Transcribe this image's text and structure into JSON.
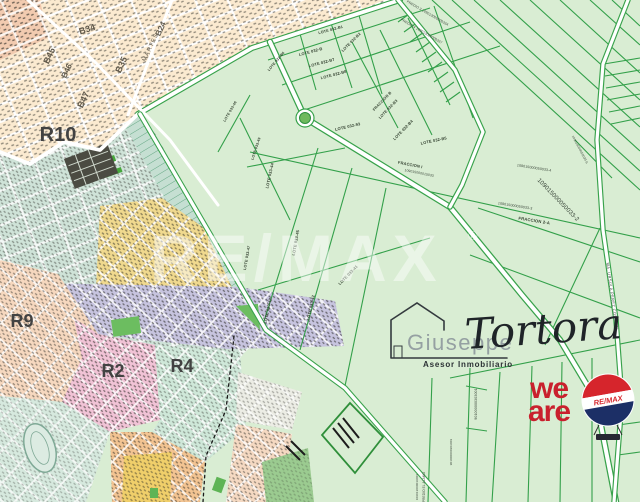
{
  "map": {
    "regions": [
      "R10",
      "R9",
      "R2",
      "R4"
    ],
    "blocks": [
      "B34",
      "B45",
      "B46",
      "B47",
      "B35",
      "B24"
    ],
    "street": "MARTES",
    "parcels": [
      "LOTE 032-B6",
      "LOTE 032-B",
      "LOTE 032-B1",
      "LOTE 032-B2",
      "LOTE 032-B7",
      "LOTE 032-B8",
      "LOTE 032-93",
      "FRACCION B",
      "LOTE 032-B3",
      "LOTE 032-B4",
      "LOTE 032-B5",
      "FRACCION I",
      "109015000015033",
      "LOTE 033-46",
      "LOTE 033-49",
      "LOTE 033-44",
      "LOTE 033-45",
      "LOTE 033-47",
      "LOTE 033-43",
      "LOTE 033-42",
      "LOTE 033-41",
      "PREDIO 3 109013000000334",
      "PREDIO 4 109013000000337",
      "109015000050033-6",
      "109015000050033-4",
      "109015000050033-2",
      "109015000050033-3",
      "FRACCION 2-A",
      "901000000303001",
      "901000000303003",
      "PREDIO EL ALAMO",
      "109013000019001"
    ],
    "road_label": "MA. URSULA PEREZ CORONEL",
    "watermark": {
      "text": "RE/MAX",
      "mark": "®"
    }
  },
  "branding": {
    "first_name": "Giuseppe",
    "last_name": "Tortora",
    "tagline": "Asesor Inmobiliario",
    "weare": [
      "we",
      "are"
    ],
    "balloon_label": "RE/MAX"
  },
  "colors": {
    "land_green": "#d9edd3",
    "line_green": "#38a24b",
    "urban_cream": "#fbead0",
    "teal_zone": "#cfe3d8",
    "yellow_zone": "#f0d98e",
    "lavender_zone": "#c7c4df",
    "peach_zone": "#f6d8bf",
    "pink_zone": "#f1c3d6",
    "mint_zone": "#cfe8d9",
    "orange_zone": "#f3c492",
    "brand_red": "#c9202d",
    "balloon_red": "#d6252c",
    "balloon_navy": "#1c2f66"
  }
}
